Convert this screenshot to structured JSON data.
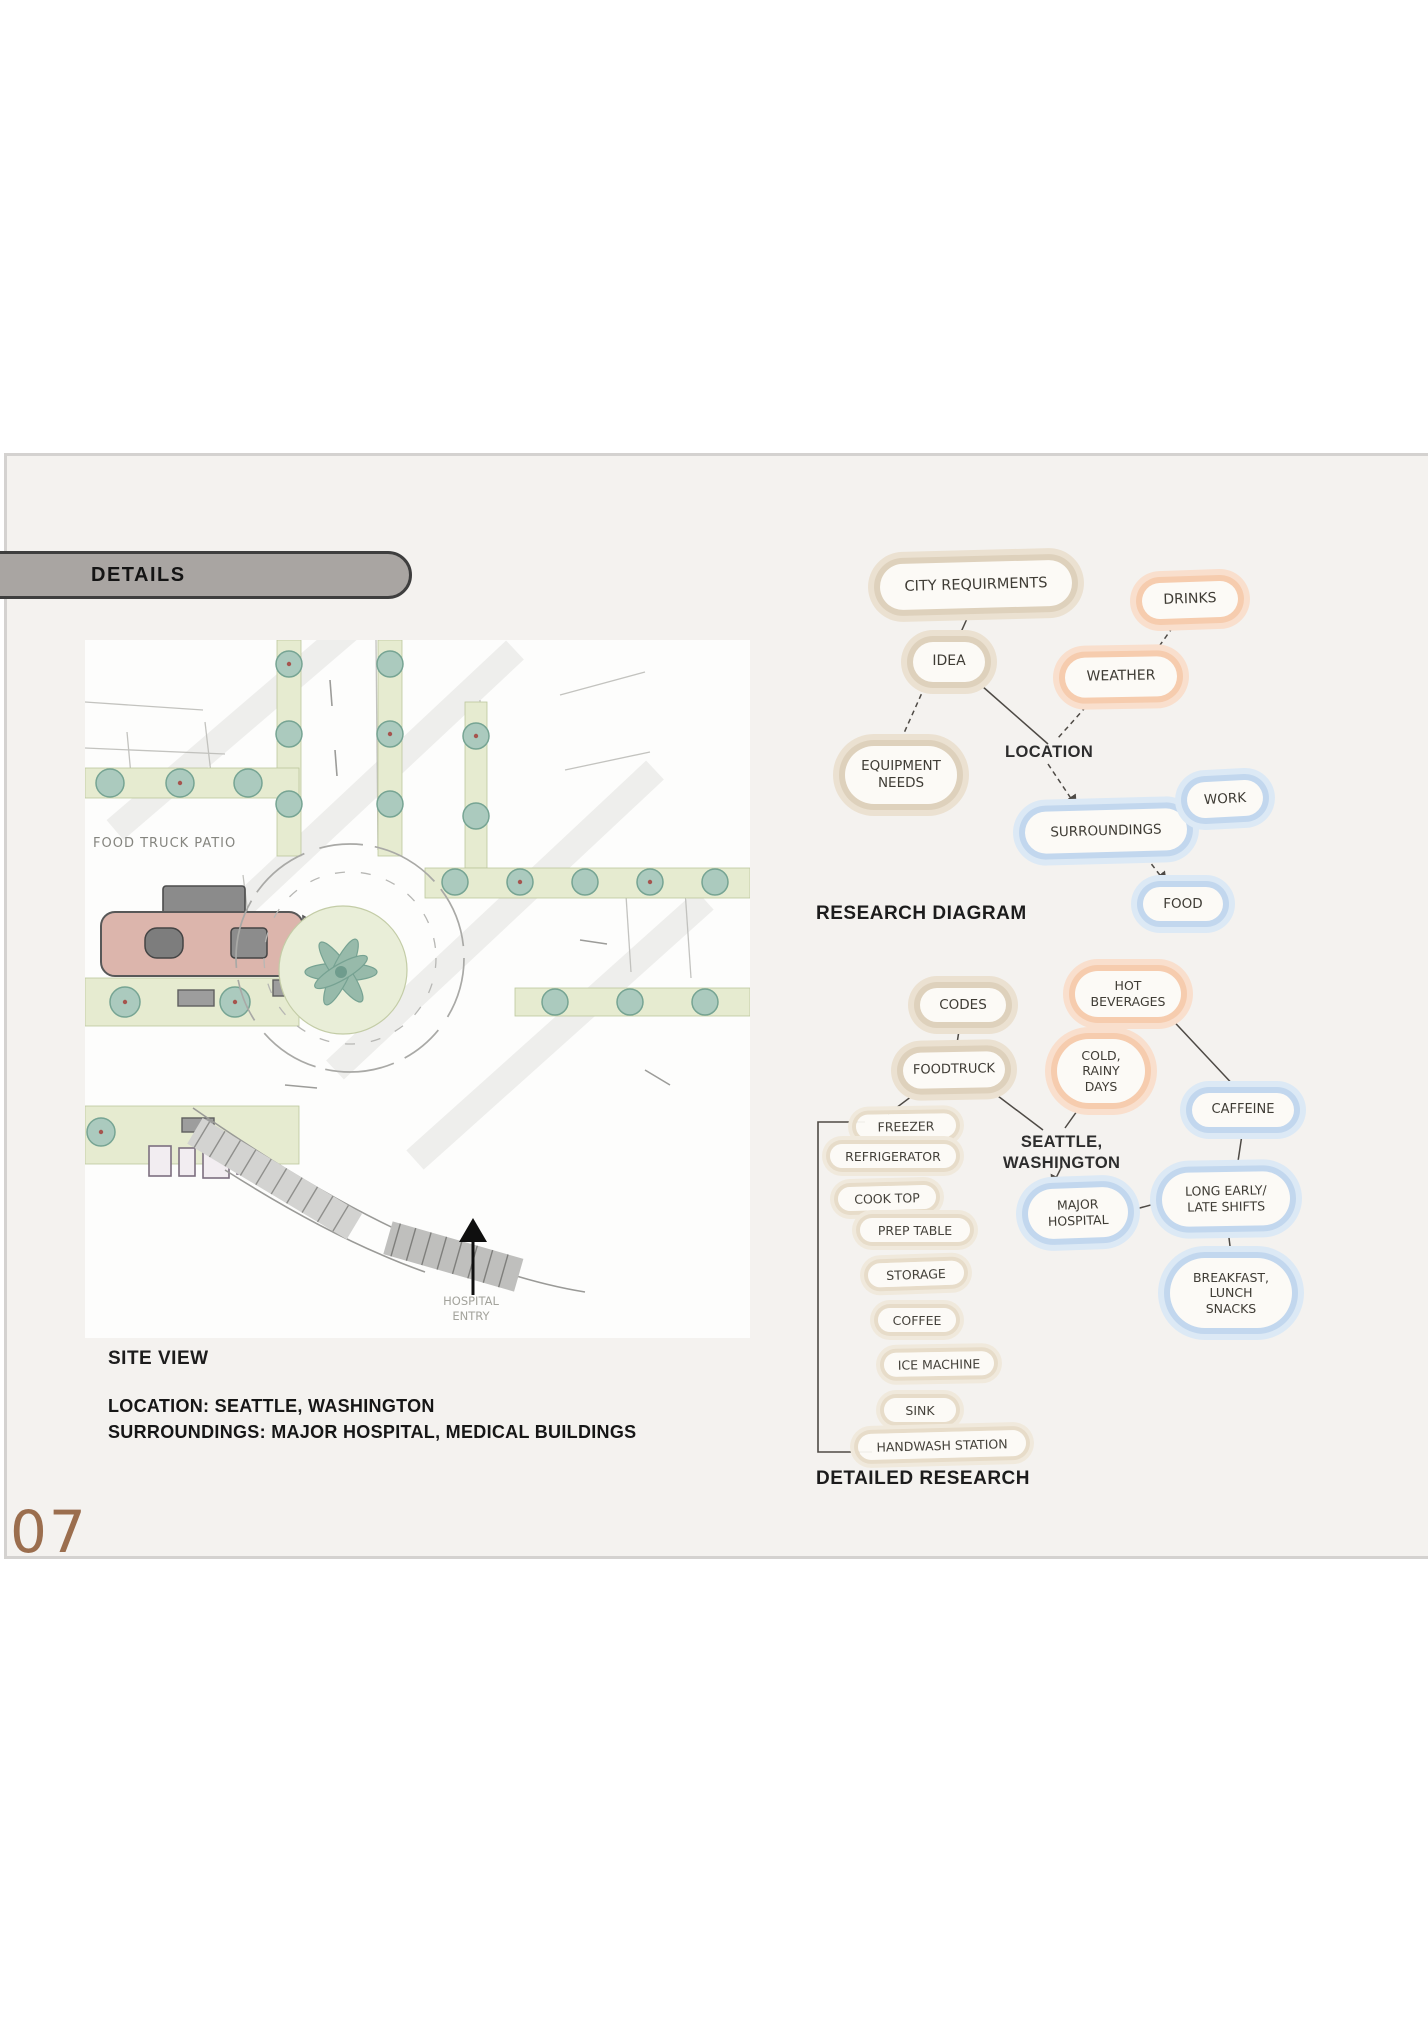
{
  "page": {
    "number": "07"
  },
  "tab": {
    "label": "DETAILS"
  },
  "site_view": {
    "caption": "SITE VIEW",
    "location": "LOCATION: SEATTLE, WASHINGTON",
    "surroundings": "SURROUNDINGS: MAJOR HOSPITAL, MEDICAL BUILDINGS",
    "sketch": {
      "food_truck_patio": "FOOD TRUCK PATIO",
      "hospital_entry": "HOSPITAL\nENTRY"
    }
  },
  "research_diagram": {
    "caption": "RESEARCH DIAGRAM",
    "typed_label": "LOCATION",
    "nodes": [
      {
        "label": "CITY REQUIRMENTS",
        "color": "tan"
      },
      {
        "label": "IDEA",
        "color": "tan"
      },
      {
        "label": "EQUIPMENT\nNEEDS",
        "color": "tan"
      },
      {
        "label": "DRINKS",
        "color": "peach"
      },
      {
        "label": "WEATHER",
        "color": "peach"
      },
      {
        "label": "SURROUNDINGS",
        "color": "blue"
      },
      {
        "label": "WORK",
        "color": "blue"
      },
      {
        "label": "FOOD",
        "color": "blue"
      }
    ]
  },
  "detailed_research": {
    "caption": "DETAILED RESEARCH",
    "typed_label": "SEATTLE,\nWASHINGTON",
    "nodes": [
      {
        "label": "CODES",
        "color": "tan"
      },
      {
        "label": "FOODTRUCK",
        "color": "tan"
      },
      {
        "label": "HOT\nBEVERAGES",
        "color": "peach"
      },
      {
        "label": "COLD,\nRAINY\nDAYS",
        "color": "peach"
      },
      {
        "label": "CAFFEINE",
        "color": "blue"
      },
      {
        "label": "MAJOR\nHOSPITAL",
        "color": "blue"
      },
      {
        "label": "LONG EARLY/\nLATE SHIFTS",
        "color": "blue"
      },
      {
        "label": "BREAKFAST,\nLUNCH\nSNACKS",
        "color": "blue"
      }
    ],
    "equipment_list": [
      "FREEZER",
      "REFRIGERATOR",
      "COOK TOP",
      "PREP TABLE",
      "STORAGE",
      "COFFEE",
      "ICE MACHINE",
      "SINK",
      "HANDWASH STATION"
    ]
  },
  "colors": {
    "accent_brown": "#9b6e4e",
    "tan_ring": "#ded1bc",
    "peach_ring": "#f6ccae",
    "blue_ring": "#c2d7ee"
  }
}
